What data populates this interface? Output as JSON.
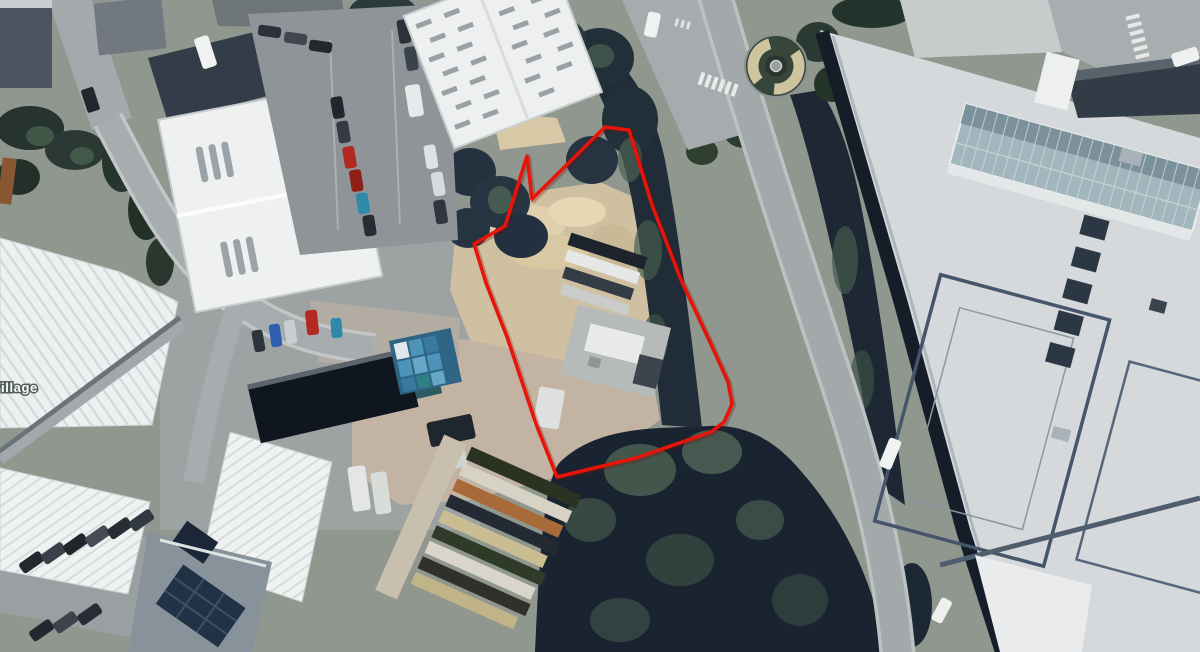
{
  "map": {
    "type": "aerial-satellite-view",
    "place_label": "Village",
    "boundary": {
      "name": "site-boundary",
      "stroke_color": "#e8140a",
      "points": "605,127 629,130 652,205 681,280 709,340 728,382 732,404 724,422 711,432 636,458 557,477 536,424 507,337 486,283 474,244 505,226 527,156 532,199"
    },
    "palette": {
      "forest_dark": "#1a2430",
      "canopy_light": "#516757",
      "sand_yard": "#d0c0a2",
      "road_asphalt": "#a3a8aa",
      "roof_white": "#eff1f1",
      "roof_dark": "#2e3842",
      "right_building_roof": "#d5d9dc",
      "glass_roof": "#a2b6bd"
    }
  }
}
